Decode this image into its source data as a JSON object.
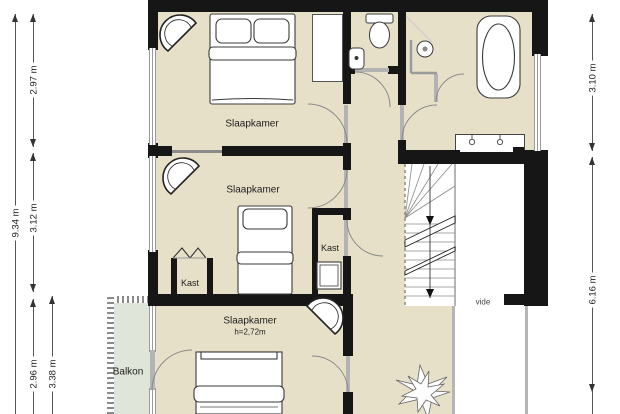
{
  "plan": {
    "title": "first-floor plan with three bedrooms, bathroom, landing and balcony",
    "rooms": {
      "bedroom1_label": "Slaapkamer",
      "bedroom2_label": "Slaapkamer",
      "bedroom3_label": "Slaapkamer",
      "bedroom3_ceiling_height": "h=2,72m",
      "closet1_label": "Kast",
      "closet2_label": "Kast",
      "balcony_label": "Balkon",
      "void_label": "vide"
    },
    "dimensions": {
      "left_total": "9.34 m",
      "left_seg1": "2.97 m",
      "left_seg2": "3.12 m",
      "left_seg3": "2.96 m",
      "left_seg3_inner": "3.38 m",
      "right_seg1": "3.10 m",
      "right_seg2": "6.16 m"
    },
    "colors": {
      "floor": "#e7e0c9",
      "balcony": "#dfe5d8",
      "wall": "#161616",
      "background": "#ffffff",
      "dimension_text": "#222222"
    }
  }
}
